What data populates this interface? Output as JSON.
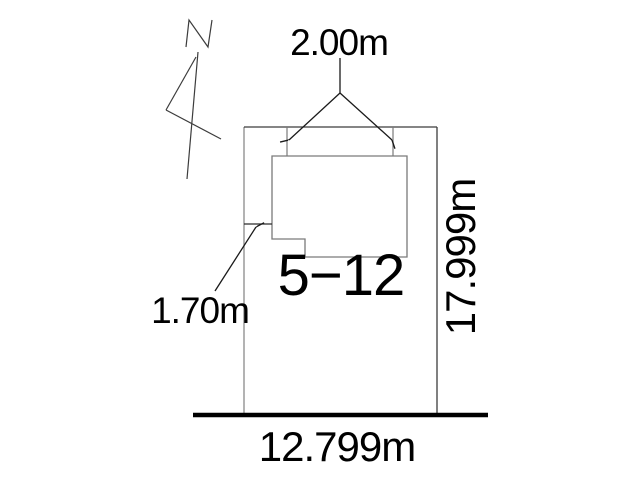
{
  "diagram": {
    "type": "site-plan",
    "labels": {
      "top_width": "2.00m",
      "side_setback": "1.70m",
      "lot_number": "5−12",
      "frontage": "12.799m",
      "depth": "17.999m"
    },
    "north_arrow": {
      "letter": "N"
    },
    "colors": {
      "background": "#ffffff",
      "outline_dark": "#3c3c3c",
      "outline_light": "#8a8a8a",
      "dimension_line": "#1a1a1a",
      "road_line": "#000000",
      "text": "#000000"
    }
  }
}
